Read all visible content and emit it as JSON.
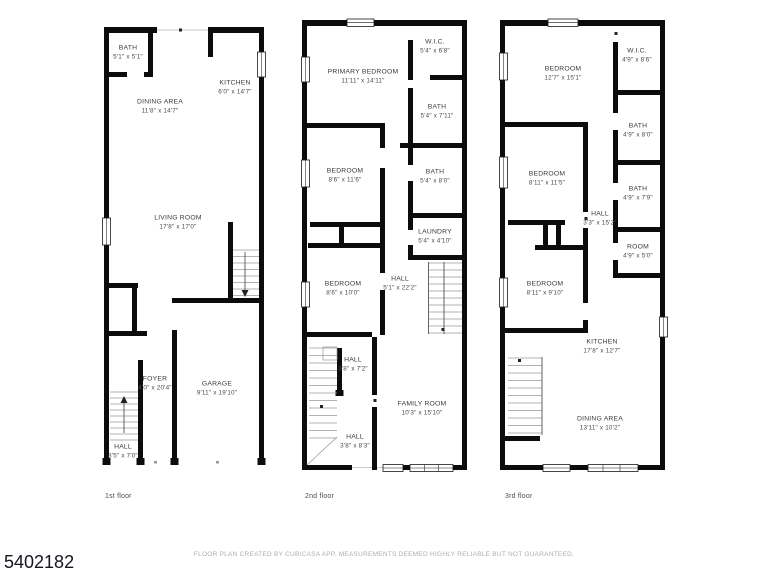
{
  "page": {
    "id_number": "5402182",
    "disclaimer": "FLOOR PLAN CREATED BY CUBICASA APP. MEASUREMENTS DEEMED HIGHLY RELIABLE BUT NOT GUARANTEED."
  },
  "colors": {
    "wall": "#0c0c0c",
    "room_label": "#3b3b3b",
    "floor_label": "#4d4d4d",
    "disclaimer": "#aeaeae",
    "id_text": "#15151f"
  },
  "floors": [
    {
      "label": "1st floor",
      "rooms": [
        {
          "name": "BATH",
          "dims": "5'1\" x 5'1\""
        },
        {
          "name": "DINING AREA",
          "dims": "11'8\" x 14'7\""
        },
        {
          "name": "KITCHEN",
          "dims": "6'0\" x 14'7\""
        },
        {
          "name": "LIVING ROOM",
          "dims": "17'8\" x 17'0\""
        },
        {
          "name": "FOYER",
          "dims": "4'0\" x 20'4\""
        },
        {
          "name": "GARAGE",
          "dims": "9'11\" x 19'10\""
        },
        {
          "name": "HALL",
          "dims": "3'5\" x 7'0\""
        }
      ]
    },
    {
      "label": "2nd floor",
      "rooms": [
        {
          "name": "PRIMARY BEDROOM",
          "dims": "11'11\" x 14'11\""
        },
        {
          "name": "W.I.C.",
          "dims": "5'4\" x 6'8\""
        },
        {
          "name": "BATH",
          "dims": "5'4\" x 7'11\""
        },
        {
          "name": "BEDROOM",
          "dims": "8'6\" x 11'6\""
        },
        {
          "name": "BATH",
          "dims": "5'4\" x 8'0\""
        },
        {
          "name": "LAUNDRY",
          "dims": "5'4\" x 4'10\""
        },
        {
          "name": "BEDROOM",
          "dims": "8'6\" x 10'0\""
        },
        {
          "name": "HALL",
          "dims": "5'1\" x 22'2\""
        },
        {
          "name": "HALL",
          "dims": "3'8\" x 7'2\""
        },
        {
          "name": "FAMILY ROOM",
          "dims": "10'3\" x 15'10\""
        },
        {
          "name": "HALL",
          "dims": "3'8\" x 8'3\""
        }
      ]
    },
    {
      "label": "3rd floor",
      "rooms": [
        {
          "name": "BEDROOM",
          "dims": "12'7\" x 15'1\""
        },
        {
          "name": "W.I.C.",
          "dims": "4'9\" x 8'6\""
        },
        {
          "name": "BATH",
          "dims": "4'9\" x 8'0\""
        },
        {
          "name": "BEDROOM",
          "dims": "8'11\" x 11'5\""
        },
        {
          "name": "BATH",
          "dims": "4'9\" x 7'9\""
        },
        {
          "name": "HALL",
          "dims": "3'3\" x 15'2\""
        },
        {
          "name": "ROOM",
          "dims": "4'9\" x 5'0\""
        },
        {
          "name": "BEDROOM",
          "dims": "8'11\" x 9'10\""
        },
        {
          "name": "KITCHEN",
          "dims": "17'8\" x 12'7\""
        },
        {
          "name": "DINING AREA",
          "dims": "13'11\" x 10'2\""
        }
      ]
    }
  ]
}
